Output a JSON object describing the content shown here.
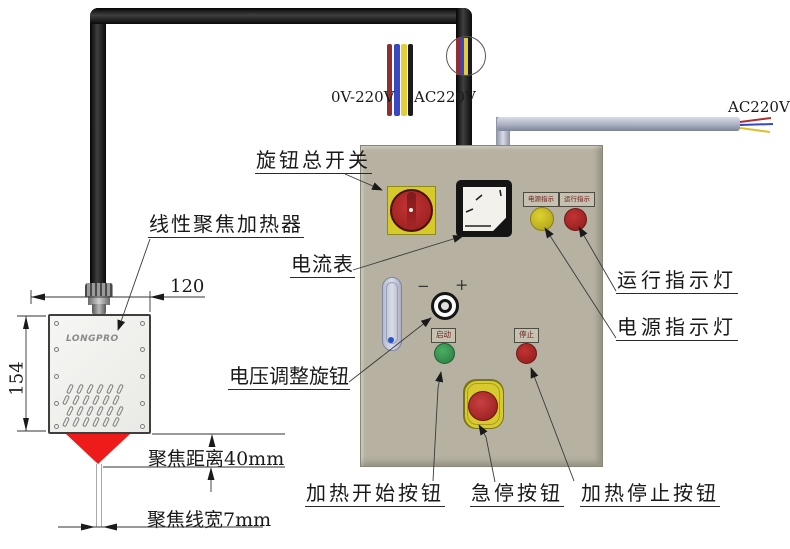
{
  "callouts": {
    "knob_switch": "旋钮总开关",
    "ammeter": "电流表",
    "heater": "线性聚焦加热器",
    "voltage_knob": "电压调整旋钮",
    "run_light": "运行指示灯",
    "power_light": "电源指示灯",
    "heat_start": "加热开始按钮",
    "estop": "急停按钮",
    "heat_stop": "加热停止按钮"
  },
  "dimensions": {
    "box_width": "120",
    "box_height": "154",
    "focus_distance": "聚焦距离40mm",
    "focus_width": "聚焦线宽7mm"
  },
  "wiring": {
    "bundle_left": "0V-220V",
    "bundle_right": "AC220V",
    "output": "AC220V"
  },
  "panel_labels": {
    "power_plate": "电源指示",
    "run_plate": "运行指示",
    "start_plate": "启动",
    "stop_plate": "停止",
    "minus": "−",
    "plus": "+"
  },
  "device": {
    "logo": "LONGPRO"
  },
  "colors": {
    "panel": "#b6b1a1",
    "switch_yellow": "#d6ca2a",
    "indicator_yellow": "#d4c92b",
    "indicator_red": "#b02a2a",
    "button_green": "#3f9e55",
    "estop_yellow": "#d6ca2e",
    "focus_red": "#ee1b1b"
  }
}
